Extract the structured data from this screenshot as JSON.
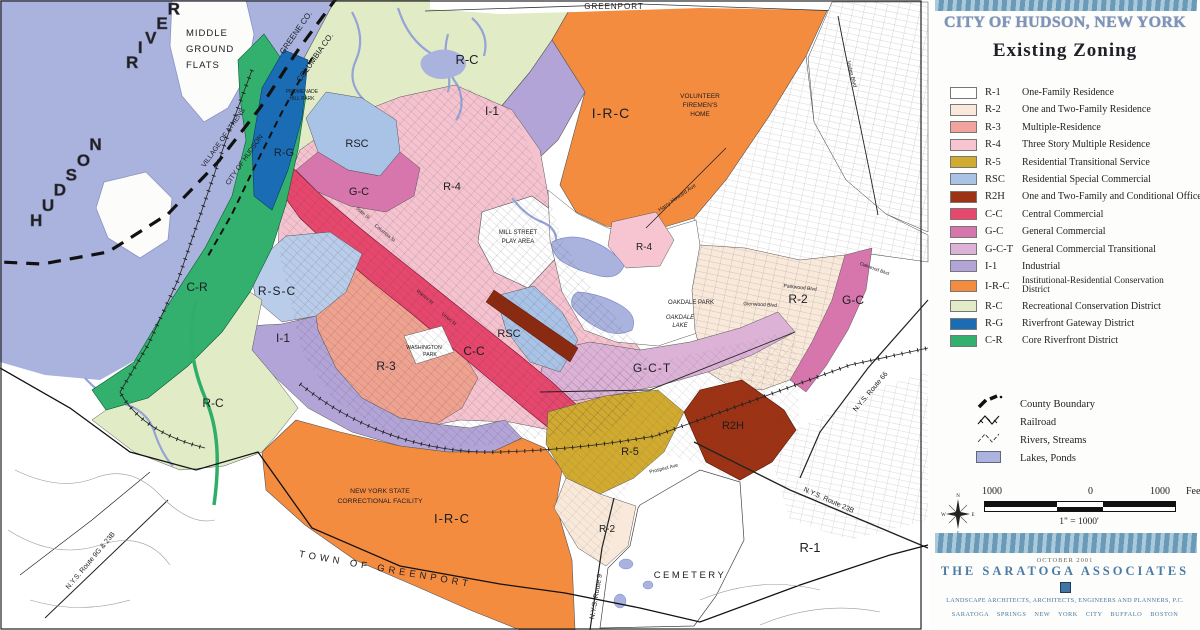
{
  "header": {
    "title": "CITY OF HUDSON, NEW YORK",
    "subtitle": "Existing Zoning"
  },
  "legend": {
    "items": [
      {
        "code": "R-1",
        "label": "One-Family Residence",
        "color": "#ffffff"
      },
      {
        "code": "R-2",
        "label": "One and Two-Family Residence",
        "color": "#f9e9da"
      },
      {
        "code": "R-3",
        "label": "Multiple-Residence",
        "color": "#f1a39d"
      },
      {
        "code": "R-4",
        "label": "Three Story Multiple Residence",
        "color": "#f6c5d1"
      },
      {
        "code": "R-5",
        "label": "Residential Transitional Service",
        "color": "#d1aa30"
      },
      {
        "code": "RSC",
        "label": "Residential Special Commercial",
        "color": "#a9c3e7"
      },
      {
        "code": "R2H",
        "label": "One and Two-Family and Conditional Office",
        "color": "#9d3314"
      },
      {
        "code": "C-C",
        "label": "Central Commercial",
        "color": "#e8476d"
      },
      {
        "code": "G-C",
        "label": "General Commercial",
        "color": "#d776ad"
      },
      {
        "code": "G-C-T",
        "label": "General Commercial Transitional",
        "color": "#dcb2d7"
      },
      {
        "code": "I-1",
        "label": "Industrial",
        "color": "#b3a4d7"
      },
      {
        "code": "I-R-C",
        "label": "Institutional-Residential Conservation District",
        "color": "#f48c40"
      },
      {
        "code": "R-C",
        "label": "Recreational Conservation District",
        "color": "#e1ecc7"
      },
      {
        "code": "R-G",
        "label": "Riverfront Gateway District",
        "color": "#1a6db5"
      },
      {
        "code": "C-R",
        "label": "Core Riverfront District",
        "color": "#33b06e"
      }
    ],
    "symbols": [
      {
        "label": "County Boundary"
      },
      {
        "label": "Railroad"
      },
      {
        "label": "Rivers, Streams"
      },
      {
        "label": "Lakes, Ponds",
        "color": "#aab4df"
      }
    ],
    "scale": {
      "left": "1000",
      "zero": "0",
      "right": "1000",
      "unit": "Feet",
      "ratio": "1\" = 1000'"
    },
    "compass": {
      "n": "N",
      "s": "S",
      "e": "E",
      "w": "W"
    }
  },
  "credits": {
    "date": "OCTOBER 2001",
    "firm": "THE SARATOGA ASSOCIATES",
    "line1": "LANDSCAPE ARCHITECTS, ARCHITECTS, ENGINEERS AND PLANNERS, P.C.",
    "line2": "SARATOGA SPRINGS  NEW YORK CITY  BUFFALO  BOSTON"
  },
  "map": {
    "labels": [
      {
        "text": "HUDSON"
      },
      {
        "text": "RIVER"
      },
      {
        "text": "MIDDLE"
      },
      {
        "text": "GROUND"
      },
      {
        "text": "FLATS"
      },
      {
        "text": "GREENE CO."
      },
      {
        "text": "COLUMBIA CO."
      },
      {
        "text": "VILLAGE OF ATHENS"
      },
      {
        "text": "CITY OF HUDSON"
      },
      {
        "text": "PROMENADE"
      },
      {
        "text": "HILL PARK"
      },
      {
        "text": "R-G"
      },
      {
        "text": "RSC"
      },
      {
        "text": "G-C"
      },
      {
        "text": "R-4"
      },
      {
        "text": "R-C"
      },
      {
        "text": "I-1"
      },
      {
        "text": "I-R-C"
      },
      {
        "text": "VOLUNTEER"
      },
      {
        "text": "FIREMEN'S"
      },
      {
        "text": "HOME"
      },
      {
        "text": "GREENPORT"
      },
      {
        "text": "MILL STREET"
      },
      {
        "text": "PLAY AREA"
      },
      {
        "text": "C-R"
      },
      {
        "text": "R-S-C"
      },
      {
        "text": "I-1"
      },
      {
        "text": "R-3"
      },
      {
        "text": "WASHINGTON"
      },
      {
        "text": "PARK"
      },
      {
        "text": "C-C"
      },
      {
        "text": "RSC"
      },
      {
        "text": "G-C-T"
      },
      {
        "text": "R-4"
      },
      {
        "text": "OAKDALE PARK"
      },
      {
        "text": "OAKDALE"
      },
      {
        "text": "LAKE"
      },
      {
        "text": "R-2"
      },
      {
        "text": "G-C"
      },
      {
        "text": "R-5"
      },
      {
        "text": "R2H"
      },
      {
        "text": "R-2"
      },
      {
        "text": "R-1"
      },
      {
        "text": "CEMETERY"
      },
      {
        "text": "I-R-C"
      },
      {
        "text": "NEW YORK STATE"
      },
      {
        "text": "CORRECTIONAL FACILITY"
      },
      {
        "text": "R-C"
      },
      {
        "text": "TOWN OF GREENPORT"
      },
      {
        "text": "N.Y.S. Route 9G & 23B"
      },
      {
        "text": "N.Y.S. Route 9"
      },
      {
        "text": "N.Y.S. Route 66"
      },
      {
        "text": "N.Y.S. Route 23B"
      },
      {
        "text": "Joslen Blvd"
      },
      {
        "text": "Harry Howard Ave"
      },
      {
        "text": "Parkwood Blvd"
      },
      {
        "text": "Glenwood Blvd"
      },
      {
        "text": "Oakwood Blvd"
      },
      {
        "text": "Prospect Ave"
      },
      {
        "text": "Warren St"
      },
      {
        "text": "Union St"
      },
      {
        "text": "Columbia St"
      },
      {
        "text": "State St"
      }
    ]
  }
}
